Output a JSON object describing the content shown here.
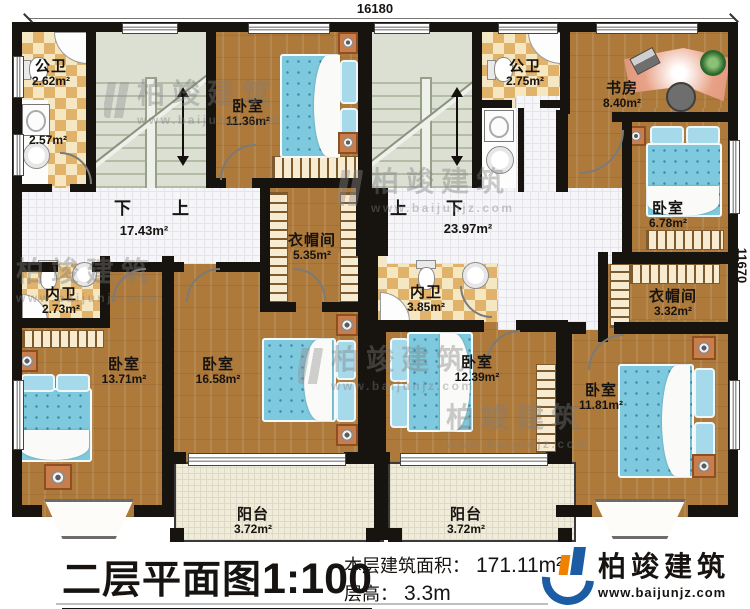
{
  "dimensions": {
    "top": "16180",
    "right": "11670"
  },
  "stairs": {
    "left": {
      "down": "下",
      "up": "上"
    },
    "right": {
      "up": "上",
      "down": "下"
    }
  },
  "rooms": {
    "public_bath_left": {
      "label": "公卫",
      "area": "2.62m²"
    },
    "laundry_left": {
      "area": "2.57m²"
    },
    "bedroom_top": {
      "label": "卧室",
      "area": "11.36m²"
    },
    "hall_left": {
      "area": "17.43m²"
    },
    "closet_center": {
      "label": "衣帽间",
      "area": "5.35m²"
    },
    "private_bath_left": {
      "label": "内卫",
      "area": "2.73m²"
    },
    "bedroom_left": {
      "label": "卧室",
      "area": "13.71m²"
    },
    "bedroom_mid_left": {
      "label": "卧室",
      "area": "16.58m²"
    },
    "balcony_left": {
      "label": "阳台",
      "area": "3.72m²"
    },
    "public_bath_right": {
      "label": "公卫",
      "area": "2.75m²"
    },
    "study": {
      "label": "书房",
      "area": "8.40m²"
    },
    "bedroom_right_top": {
      "label": "卧室",
      "area": "6.78m²"
    },
    "hall_right": {
      "area": "23.97m²"
    },
    "private_bath_right": {
      "label": "内卫",
      "area": "3.85m²"
    },
    "closet_right": {
      "label": "衣帽间",
      "area": "3.32m²"
    },
    "bedroom_mid_right": {
      "label": "卧室",
      "area": "12.39m²"
    },
    "bedroom_bottom_right": {
      "label": "卧室",
      "area": "11.81m²"
    },
    "balcony_right": {
      "label": "阳台",
      "area": "3.72m²"
    }
  },
  "title_block": {
    "plan_name": "二层平面图",
    "scale": "1:100",
    "area_label": "本层建筑面积：",
    "area_value": "171.11m²",
    "floor_height_label": "层高：",
    "floor_height_value": "3.3m",
    "logo_name": "柏竣建筑",
    "logo_site": "www.baijunjz.com"
  },
  "watermark": {
    "name": "柏竣建筑",
    "site": "www.baijunjz.com"
  },
  "colors": {
    "wall": "#17130e",
    "wood": "#ad7a3c",
    "checker": "#e0b26a",
    "bed": "#7ec9dd",
    "logo_blue": "#1c5ca5",
    "logo_orange": "#ef8200"
  }
}
